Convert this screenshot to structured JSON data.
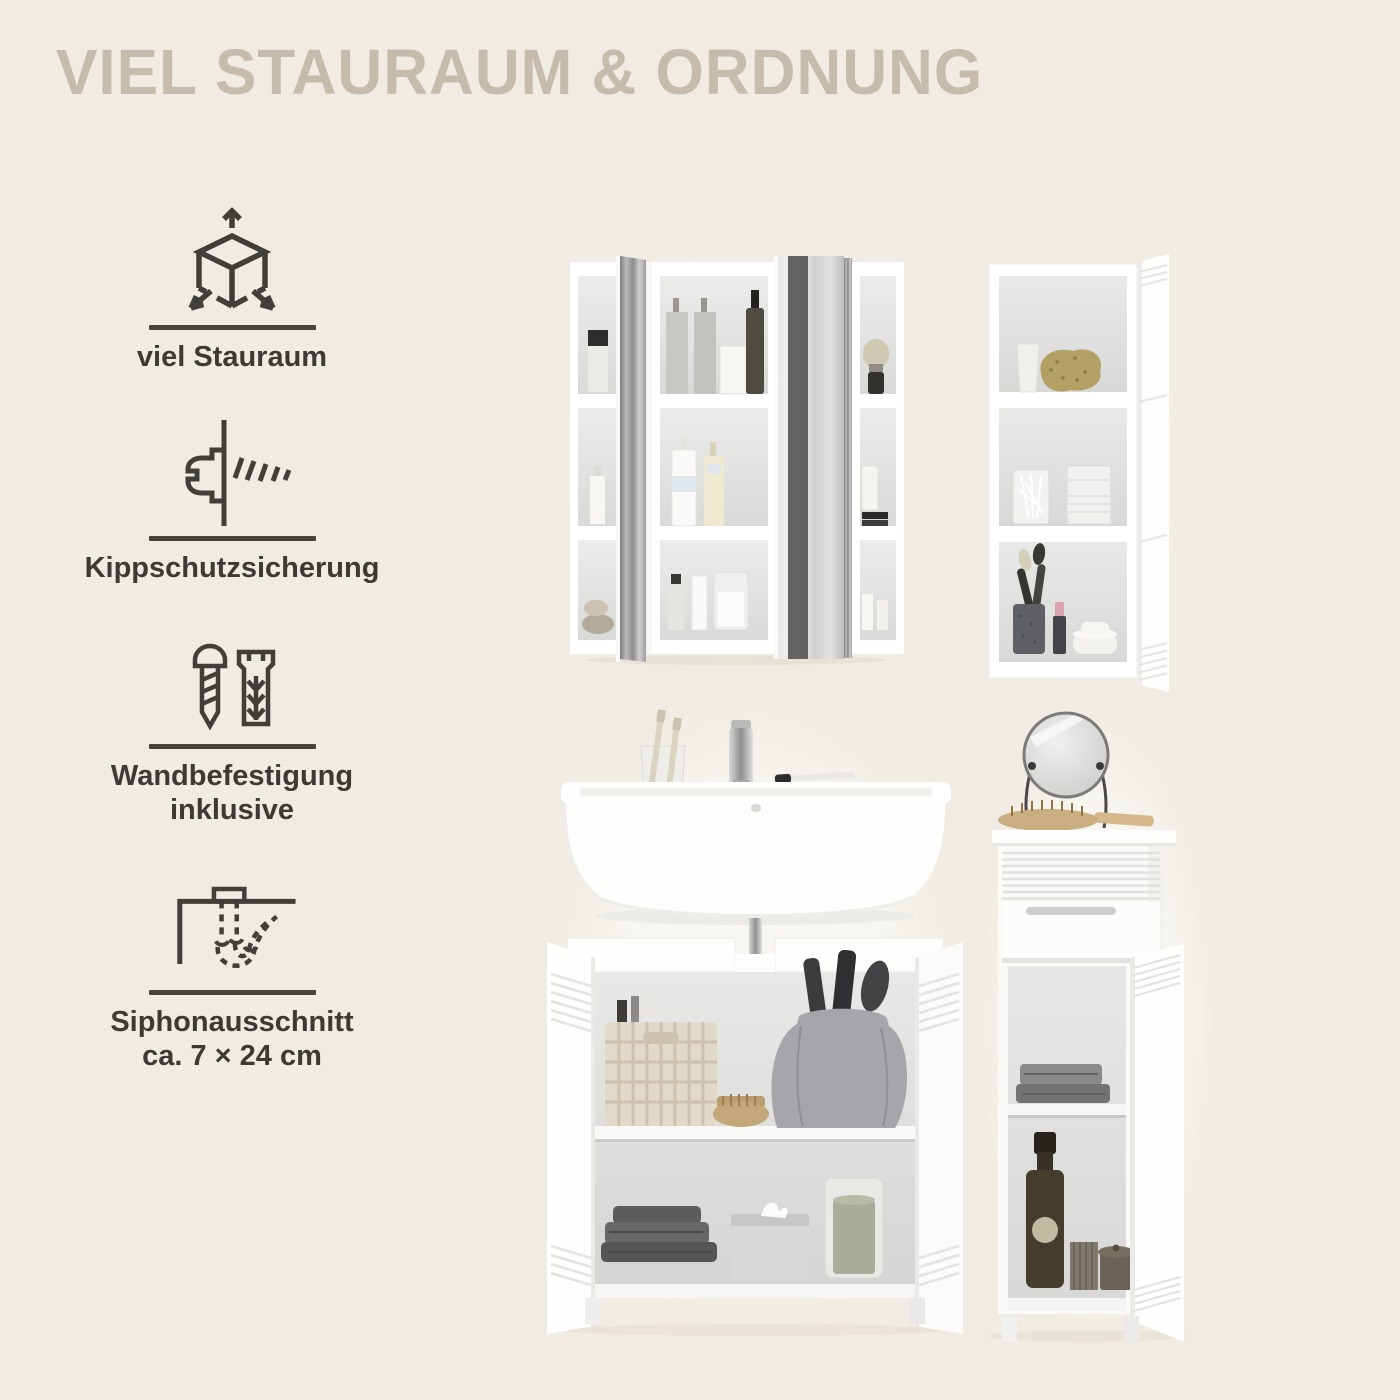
{
  "page": {
    "title": "VIEL STAURAUM & ORDNUNG",
    "background_color": "#f0ece3",
    "title_color": "#c5bcab",
    "text_color": "#3b3a35",
    "icon_stroke_color": "#403f3a"
  },
  "features": [
    {
      "icon": "cube-dimensions-icon",
      "lines": [
        "viel Stauraum"
      ]
    },
    {
      "icon": "anti-tip-lock-icon",
      "lines": [
        "Kippschutzsicherung"
      ]
    },
    {
      "icon": "screw-dowel-icon",
      "lines": [
        "Wandbefestigung",
        "inklusive"
      ]
    },
    {
      "icon": "siphon-cutout-icon",
      "lines": [
        "Siphonausschnitt",
        "ca. 7 × 24 cm"
      ]
    }
  ],
  "photos": [
    {
      "name": "mirror-cabinet-photo"
    },
    {
      "name": "wall-cabinet-photo"
    },
    {
      "name": "washbasin-cabinet-photo"
    },
    {
      "name": "floor-cabinet-photo"
    }
  ]
}
